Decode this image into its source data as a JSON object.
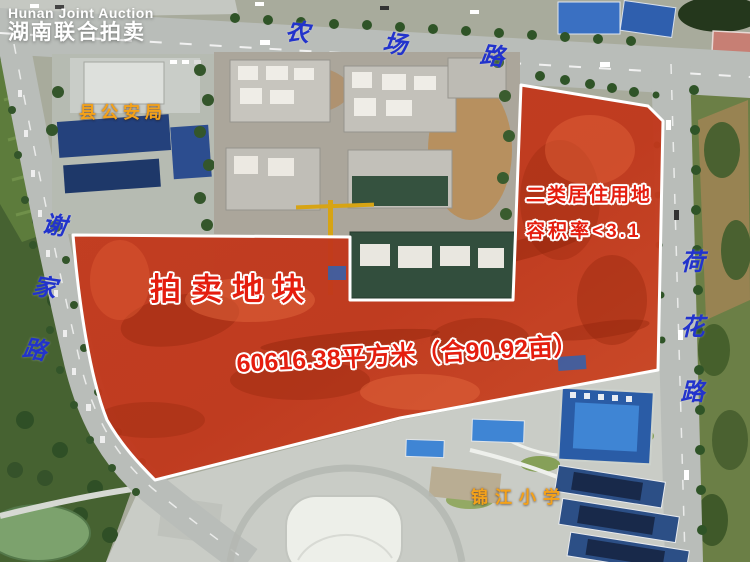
{
  "watermark": {
    "brand_en": "Hunan Joint Auction",
    "brand_zh": "湖南联合拍卖"
  },
  "roads": {
    "top_road": "农场路",
    "left_road": "谢家路",
    "right_road": "荷花路"
  },
  "landmarks": {
    "police_station": "县公安局",
    "primary_school": "锦江小学"
  },
  "parcel": {
    "label": "拍卖地块",
    "land_use": "二类居住用地",
    "plot_ratio": "容积率<3.1",
    "area": "60616.38平方米（合90.92亩）"
  },
  "colors": {
    "parcel_fill": "#c8391b",
    "parcel_border": "#ffffff",
    "road_label_blue": "#2233cc",
    "landmark_orange": "#f4a21a",
    "annotation_red": "#e51d0e",
    "watermark_white": "#ffffff"
  }
}
